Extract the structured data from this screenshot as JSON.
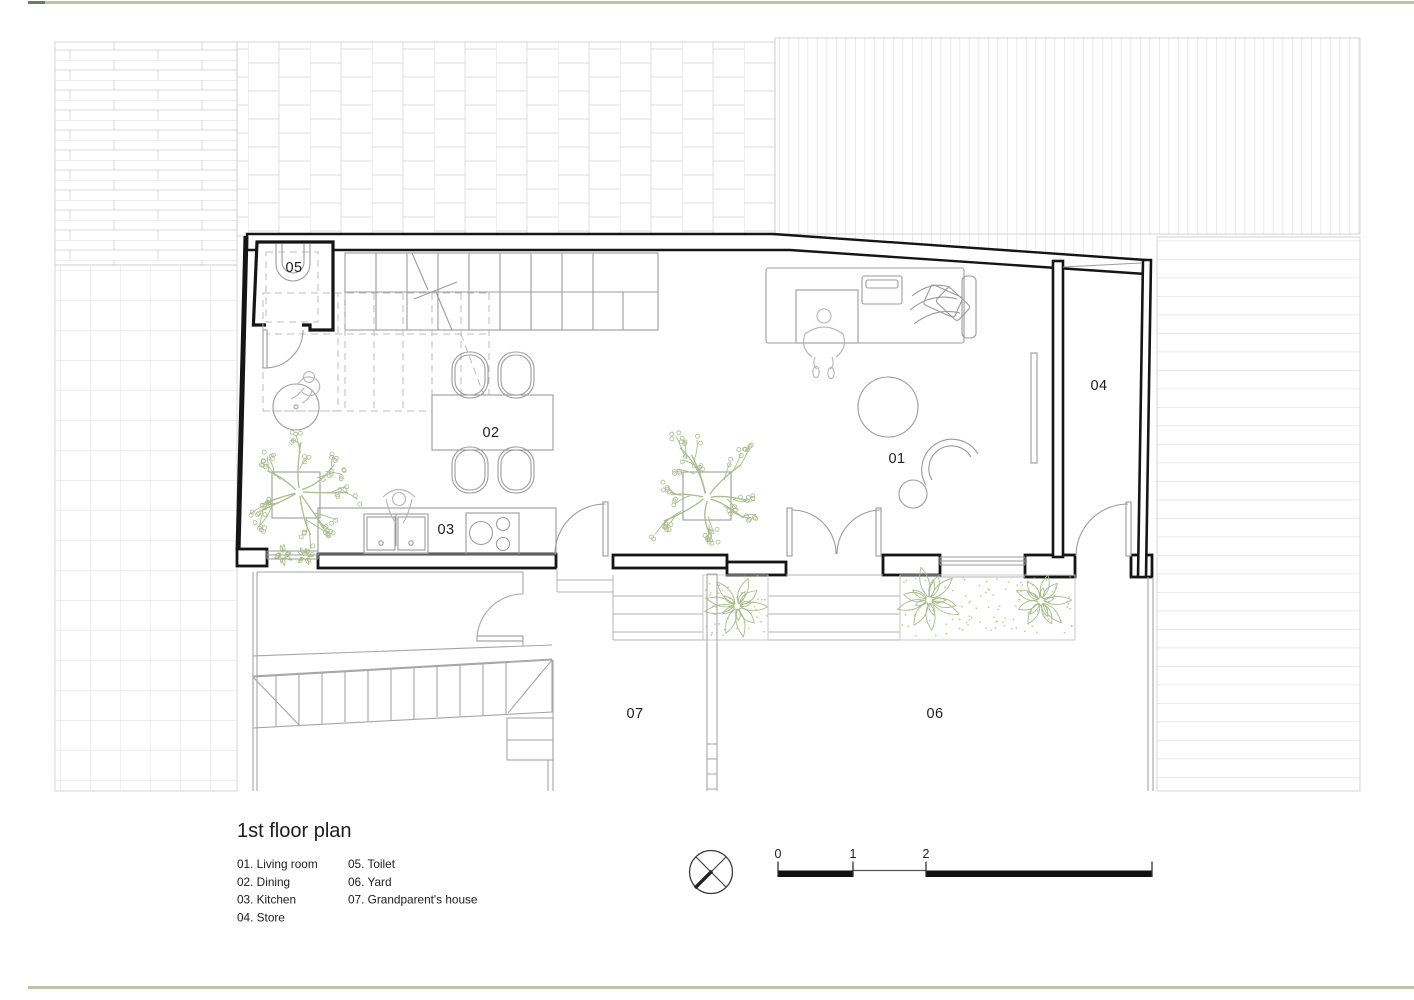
{
  "title": "1st floor plan",
  "rooms": [
    {
      "num": "01",
      "name": "Living room"
    },
    {
      "num": "02",
      "name": "Dining"
    },
    {
      "num": "03",
      "name": "Kitchen"
    },
    {
      "num": "04",
      "name": "Store"
    },
    {
      "num": "05",
      "name": "Toilet"
    },
    {
      "num": "06",
      "name": "Yard"
    },
    {
      "num": "07",
      "name": "Grandparent's house"
    }
  ],
  "scale_bar": {
    "ticks": [
      "0",
      "1",
      "2",
      "5"
    ]
  },
  "compass": "north-symbol",
  "colors": {
    "wall": "#151515",
    "furniture_line": "#9b9b9b",
    "hatch_line": "#dedede",
    "foliage": "#a7bd8b",
    "page_border": "#b9c8a2",
    "page_border_tip": "#6f7a5e",
    "dashed_line": "#bdbdbd",
    "site_line": "#a6a6a6",
    "text": "#1c1c1c"
  }
}
